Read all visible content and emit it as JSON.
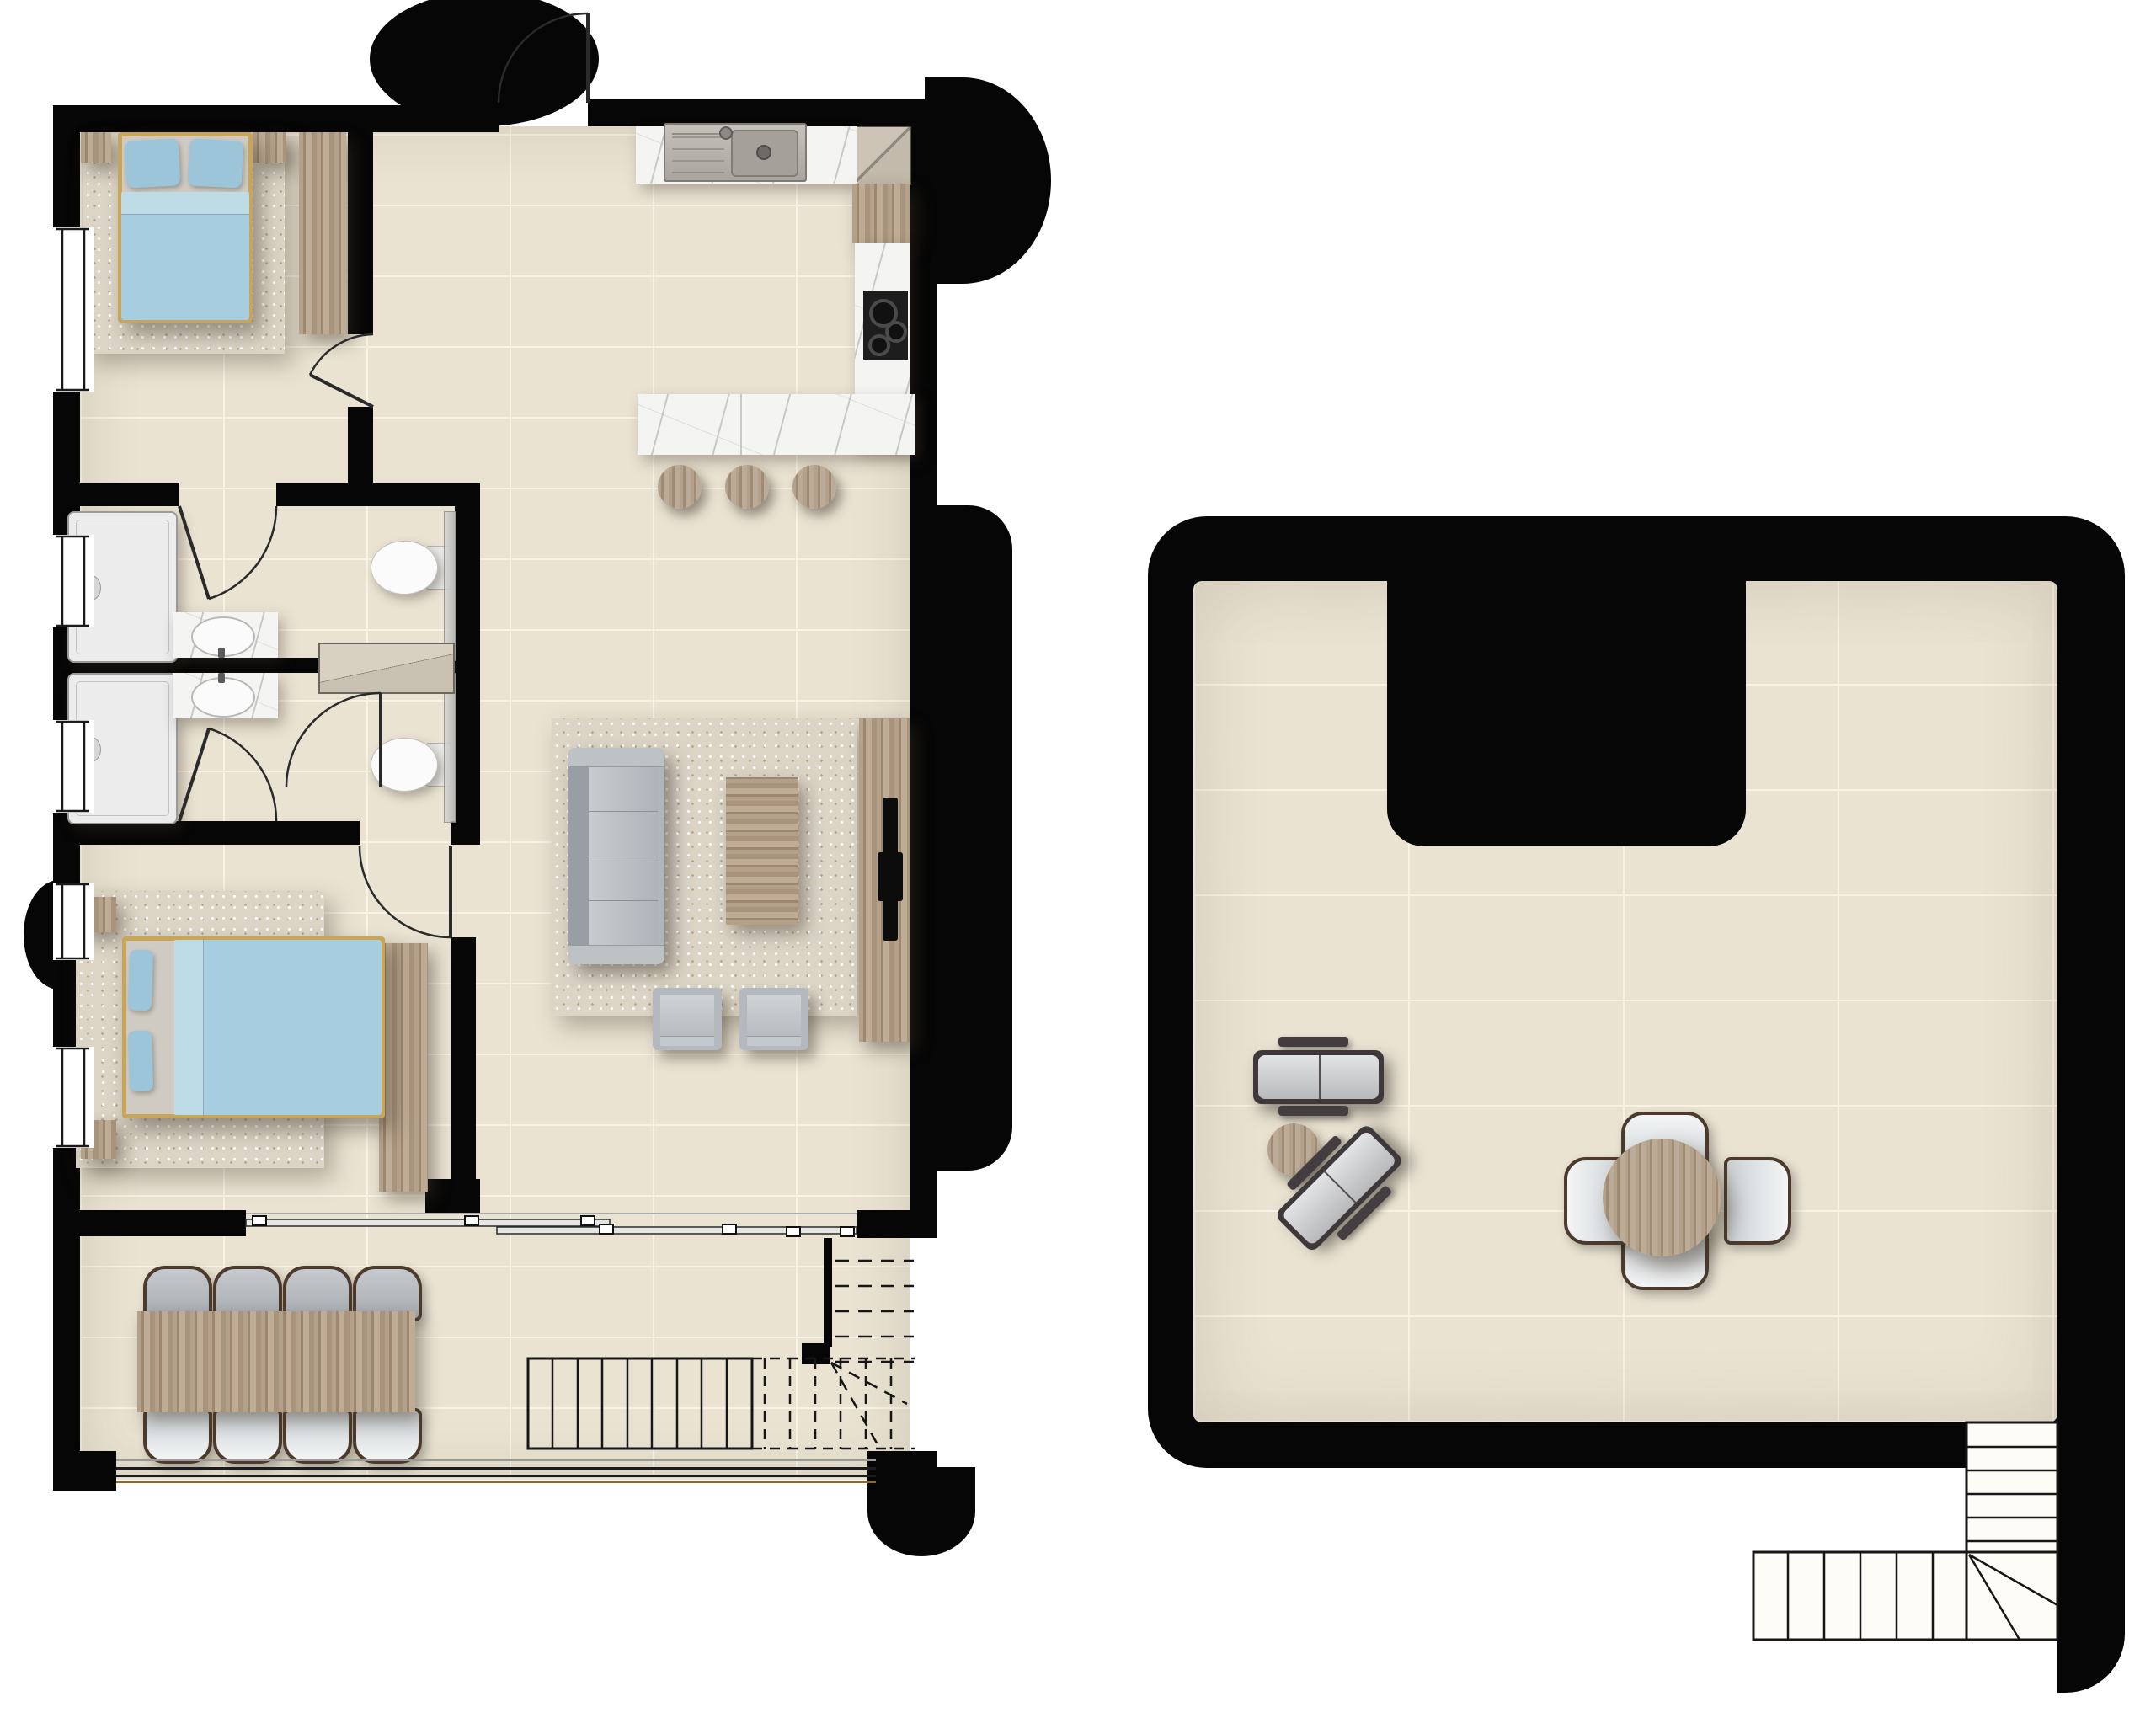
{
  "meta": {
    "type": "architectural-floor-plan",
    "views": [
      "ground-floor-unit",
      "roof-terrace"
    ],
    "visible_text": []
  },
  "colors": {
    "wall": "#060606",
    "floor": "#eae3d2",
    "grout": "#f7f2e4",
    "rug": "#dcd5c6",
    "wood": "#b2a089",
    "wood_dark": "#8f7c66",
    "travertine": "#b5a28b",
    "marble": "#f4f4f2",
    "steel": "#bdb9b2",
    "appliance": "#c9c0b0",
    "cooktop": "#1d1d1d",
    "bed_blue": "#a6cde0",
    "pillow_blue": "#9cc5d9",
    "bed_frame": "#c8a558",
    "sofa": "#b0b6bb",
    "sofa_dark": "#989ea3",
    "chair_frame": "#4c3b2c",
    "chair_white": "#eef1f2",
    "chair_gray": "#bcc1c5",
    "shower": "#ececec",
    "fixture": "#fbfbfb",
    "line": "#1f1f1f",
    "lounger_frame": "#3f383a",
    "lounger_cushion": "#cfd0d2"
  },
  "ground_floor": {
    "name": "ground-floor-unit",
    "rooms": [
      {
        "id": "bedroom-1",
        "items": [
          "double-bed",
          "pillow x2",
          "area-rug",
          "nightstand",
          "bench",
          "dresser",
          "window",
          "door"
        ]
      },
      {
        "id": "bathroom-1",
        "items": [
          "shower-tray",
          "vanity-sink",
          "toilet",
          "glass-screen",
          "window",
          "door"
        ]
      },
      {
        "id": "bathroom-2",
        "items": [
          "shower-tray",
          "vanity-sink",
          "toilet",
          "glass-screen",
          "window",
          "door"
        ]
      },
      {
        "id": "hall-closet",
        "items": [
          "shelved-closet",
          "door"
        ]
      },
      {
        "id": "bedroom-2",
        "items": [
          "double-bed",
          "pillow x2",
          "area-rug",
          "nightstand x2",
          "wardrobe",
          "window x2",
          "door",
          "sliding-door"
        ]
      },
      {
        "id": "kitchen",
        "items": [
          "sink-counter",
          "refrigerator",
          "tall-cabinet",
          "cooktop-counter",
          "island-counter",
          "bar-stool x3"
        ]
      },
      {
        "id": "living-room",
        "items": [
          "sofa",
          "coffee-table",
          "area-rug",
          "armchair x2",
          "tv-console",
          "tv",
          "sliding-door"
        ]
      },
      {
        "id": "entry",
        "items": [
          "entrance-door",
          "door-swing-arc",
          "canopy"
        ]
      },
      {
        "id": "dining-terrace",
        "items": [
          "dining-table",
          "dining-chair x8",
          "balustrade",
          "corner-post"
        ]
      },
      {
        "id": "staircase",
        "items": [
          "straight-run-10-treads",
          "dashed-hidden-run",
          "winder-break-lines"
        ]
      }
    ]
  },
  "roof_terrace": {
    "name": "roof-terrace",
    "items": [
      "sun-lounger",
      "sun-lounger-rotated-45",
      "round-side-table",
      "round-dining-table",
      "terrace-chair x4",
      "external-l-staircase",
      "u-shaped-parapet-wall"
    ]
  }
}
